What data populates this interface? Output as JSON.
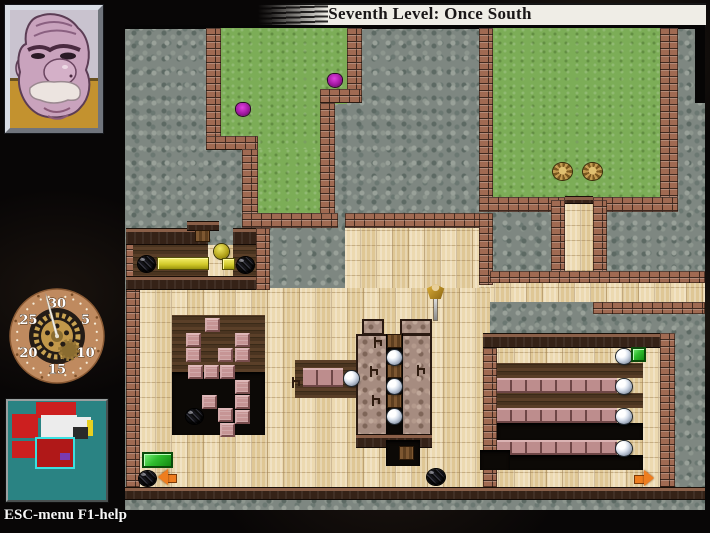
{
  "banner": {
    "title": "Seventh Level: Once South"
  },
  "hud": {
    "hint": "ESC-menu F1-help",
    "portrait": "beethro-face",
    "clock": {
      "labels": [
        {
          "text": "30",
          "angle": 0
        },
        {
          "text": "5",
          "angle": 60
        },
        {
          "text": "10",
          "angle": 120
        },
        {
          "text": "15",
          "angle": 180
        },
        {
          "text": "20",
          "angle": 240
        },
        {
          "text": "25",
          "angle": 300
        }
      ],
      "hand_angle": -15
    },
    "minimap": {
      "rooms": [
        {
          "t": "room",
          "x": 28,
          "y": 1,
          "w": 40,
          "h": 16,
          "c": "#cc1f1f"
        },
        {
          "t": "room",
          "x": 33,
          "y": 14,
          "w": 36,
          "h": 22,
          "c": "#ececec"
        },
        {
          "t": "room",
          "x": 67,
          "y": 16,
          "w": 16,
          "h": 17,
          "c": "#ececec"
        },
        {
          "t": "room",
          "x": 79,
          "y": 19,
          "w": 6,
          "h": 16,
          "c": "#e8d020"
        },
        {
          "t": "room",
          "x": 65,
          "y": 26,
          "w": 15,
          "h": 12,
          "c": "#2a2a2a"
        },
        {
          "t": "room",
          "x": 4,
          "y": 13,
          "w": 26,
          "h": 24,
          "c": "#cc1f1f"
        },
        {
          "t": "room",
          "x": 4,
          "y": 40,
          "w": 26,
          "h": 17,
          "c": "#cc1f1f"
        },
        {
          "t": "room",
          "x": 40,
          "y": 44,
          "w": 18,
          "h": 14,
          "c": "#cc1f1f"
        },
        {
          "t": "room-current",
          "x": 27,
          "y": 36,
          "w": 36,
          "h": 28,
          "c": "#b01818",
          "b": "#3ae0e0"
        },
        {
          "t": "room",
          "x": 52,
          "y": 52,
          "w": 10,
          "h": 7,
          "c": "#7a3ab0"
        }
      ]
    }
  },
  "map": {
    "regions": [
      {
        "t": "black",
        "x": 0,
        "y": 0,
        "w": 580,
        "h": 4
      },
      {
        "t": "black",
        "x": 570,
        "y": 0,
        "w": 10,
        "h": 78
      },
      {
        "t": "grass",
        "x": 96,
        "y": 3,
        "w": 126,
        "h": 76
      },
      {
        "t": "grass",
        "x": 96,
        "y": 3,
        "w": 99,
        "h": 122
      },
      {
        "t": "grass",
        "x": 133,
        "y": 124,
        "w": 62,
        "h": 66
      },
      {
        "t": "grass",
        "x": 368,
        "y": 3,
        "w": 167,
        "h": 171
      },
      {
        "t": "tan",
        "x": 440,
        "y": 175,
        "w": 28,
        "h": 85
      },
      {
        "t": "tan",
        "x": 220,
        "y": 203,
        "w": 145,
        "h": 62
      },
      {
        "t": "tan",
        "x": 354,
        "y": 258,
        "w": 226,
        "h": 19
      },
      {
        "t": "tan",
        "x": 15,
        "y": 263,
        "w": 350,
        "h": 199
      },
      {
        "t": "tan",
        "x": 358,
        "y": 323,
        "w": 177,
        "h": 139
      },
      {
        "t": "tan",
        "x": 83,
        "y": 220,
        "w": 25,
        "h": 33
      },
      {
        "t": "wall",
        "x": 81,
        "y": 3,
        "w": 15,
        "h": 122
      },
      {
        "t": "wall",
        "x": 81,
        "y": 111,
        "w": 52,
        "h": 14
      },
      {
        "t": "wall",
        "x": 117,
        "y": 124,
        "w": 16,
        "h": 66
      },
      {
        "t": "wall",
        "x": 222,
        "y": 3,
        "w": 15,
        "h": 75
      },
      {
        "t": "wall",
        "x": 195,
        "y": 64,
        "w": 42,
        "h": 14
      },
      {
        "t": "wall",
        "x": 195,
        "y": 78,
        "w": 15,
        "h": 112
      },
      {
        "t": "wall",
        "x": 117,
        "y": 188,
        "w": 96,
        "h": 15
      },
      {
        "t": "wall",
        "x": 354,
        "y": 3,
        "w": 14,
        "h": 184
      },
      {
        "t": "wall",
        "x": 535,
        "y": 3,
        "w": 18,
        "h": 184
      },
      {
        "t": "wall",
        "x": 354,
        "y": 172,
        "w": 86,
        "h": 15
      },
      {
        "t": "wall",
        "x": 468,
        "y": 172,
        "w": 85,
        "h": 15
      },
      {
        "t": "darkwall",
        "x": 440,
        "y": 171,
        "w": 28,
        "h": 8
      },
      {
        "t": "wall",
        "x": 426,
        "y": 175,
        "w": 14,
        "h": 73
      },
      {
        "t": "wall",
        "x": 468,
        "y": 175,
        "w": 14,
        "h": 73
      },
      {
        "t": "wall",
        "x": 220,
        "y": 188,
        "w": 148,
        "h": 15
      },
      {
        "t": "wall",
        "x": 354,
        "y": 188,
        "w": 14,
        "h": 72
      },
      {
        "t": "wall",
        "x": 365,
        "y": 246,
        "w": 215,
        "h": 12
      },
      {
        "t": "wall",
        "x": 468,
        "y": 277,
        "w": 112,
        "h": 12
      },
      {
        "t": "wall",
        "x": 1,
        "y": 218,
        "w": 14,
        "h": 244
      },
      {
        "t": "darkwall",
        "x": 1,
        "y": 203,
        "w": 82,
        "h": 17
      },
      {
        "t": "darkwall",
        "x": 108,
        "y": 203,
        "w": 27,
        "h": 17
      },
      {
        "t": "darkwall",
        "x": 62,
        "y": 196,
        "w": 32,
        "h": 10
      },
      {
        "t": "darkwood",
        "x": 8,
        "y": 220,
        "w": 75,
        "h": 33
      },
      {
        "t": "darkwood",
        "x": 108,
        "y": 220,
        "w": 25,
        "h": 33
      },
      {
        "t": "darkwall",
        "x": 1,
        "y": 251,
        "w": 132,
        "h": 14
      },
      {
        "t": "wall",
        "x": 131,
        "y": 203,
        "w": 14,
        "h": 62
      },
      {
        "t": "darkwood",
        "x": 47,
        "y": 290,
        "w": 93,
        "h": 57
      },
      {
        "t": "pit",
        "x": 47,
        "y": 347,
        "w": 93,
        "h": 63
      },
      {
        "t": "darkwall",
        "x": 358,
        "y": 308,
        "w": 177,
        "h": 15
      },
      {
        "t": "wall",
        "x": 358,
        "y": 323,
        "w": 14,
        "h": 139
      },
      {
        "t": "wall",
        "x": 535,
        "y": 308,
        "w": 15,
        "h": 154
      },
      {
        "t": "darkwood",
        "x": 372,
        "y": 338,
        "w": 146,
        "h": 15
      },
      {
        "t": "brickrow",
        "x": 372,
        "y": 353,
        "w": 120,
        "h": 15
      },
      {
        "t": "darkwood",
        "x": 372,
        "y": 368,
        "w": 146,
        "h": 15
      },
      {
        "t": "brickrow",
        "x": 372,
        "y": 383,
        "w": 120,
        "h": 15
      },
      {
        "t": "pit",
        "x": 372,
        "y": 398,
        "w": 146,
        "h": 17
      },
      {
        "t": "brickrow",
        "x": 372,
        "y": 415,
        "w": 120,
        "h": 15
      },
      {
        "t": "pit",
        "x": 372,
        "y": 430,
        "w": 146,
        "h": 15
      },
      {
        "t": "darkwood",
        "x": 170,
        "y": 335,
        "w": 72,
        "h": 38
      },
      {
        "t": "brickrow",
        "x": 178,
        "y": 343,
        "w": 40,
        "h": 19
      },
      {
        "t": "pinkcobble",
        "x": 237,
        "y": 294,
        "w": 22,
        "h": 16
      },
      {
        "t": "pinkcobble",
        "x": 275,
        "y": 294,
        "w": 32,
        "h": 16
      },
      {
        "t": "pinkcobble",
        "x": 231,
        "y": 309,
        "w": 76,
        "h": 102
      },
      {
        "t": "pit",
        "x": 261,
        "y": 309,
        "w": 17,
        "h": 100
      },
      {
        "t": "darkwall",
        "x": 231,
        "y": 409,
        "w": 76,
        "h": 14
      },
      {
        "t": "pit",
        "x": 261,
        "y": 415,
        "w": 34,
        "h": 26
      },
      {
        "t": "pit",
        "x": 355,
        "y": 425,
        "w": 30,
        "h": 20
      },
      {
        "t": "darkwall",
        "x": 0,
        "y": 462,
        "w": 580,
        "h": 13
      }
    ],
    "items": [
      {
        "t": "roach",
        "x": 111,
        "y": 78,
        "w": 14,
        "h": 13
      },
      {
        "t": "roach",
        "x": 203,
        "y": 49,
        "w": 14,
        "h": 13
      },
      {
        "t": "creature",
        "x": 428,
        "y": 138,
        "w": 19,
        "h": 17
      },
      {
        "t": "creature",
        "x": 458,
        "y": 138,
        "w": 19,
        "h": 17
      },
      {
        "t": "oliveorb",
        "x": 89,
        "y": 219,
        "w": 15,
        "h": 15
      },
      {
        "t": "bomb",
        "x": 13,
        "y": 231,
        "w": 17,
        "h": 16
      },
      {
        "t": "bomb",
        "x": 112,
        "y": 232,
        "w": 17,
        "h": 16
      },
      {
        "t": "bomb",
        "x": 61,
        "y": 384,
        "w": 17,
        "h": 15
      },
      {
        "t": "bomb",
        "x": 14,
        "y": 446,
        "w": 17,
        "h": 15
      },
      {
        "t": "bomb",
        "x": 302,
        "y": 444,
        "w": 18,
        "h": 16
      },
      {
        "t": "ydoor",
        "x": 32,
        "y": 232,
        "w": 52,
        "h": 13
      },
      {
        "t": "ydoor",
        "x": 97,
        "y": 233,
        "w": 13,
        "h": 12
      },
      {
        "t": "woodtile",
        "x": 70,
        "y": 205,
        "w": 15,
        "h": 12
      },
      {
        "t": "woodtile",
        "x": 262,
        "y": 309,
        "w": 15,
        "h": 14
      },
      {
        "t": "woodtile",
        "x": 262,
        "y": 339,
        "w": 15,
        "h": 14
      },
      {
        "t": "woodtile",
        "x": 262,
        "y": 369,
        "w": 15,
        "h": 14
      },
      {
        "t": "woodtile",
        "x": 274,
        "y": 421,
        "w": 15,
        "h": 14
      },
      {
        "t": "orb",
        "x": 219,
        "y": 346,
        "w": 15,
        "h": 15
      },
      {
        "t": "orb",
        "x": 262,
        "y": 325,
        "w": 15,
        "h": 15
      },
      {
        "t": "orb",
        "x": 262,
        "y": 354,
        "w": 15,
        "h": 15
      },
      {
        "t": "orb",
        "x": 262,
        "y": 384,
        "w": 15,
        "h": 15
      },
      {
        "t": "orb",
        "x": 491,
        "y": 324,
        "w": 16,
        "h": 15
      },
      {
        "t": "orb",
        "x": 491,
        "y": 354,
        "w": 16,
        "h": 15
      },
      {
        "t": "orb",
        "x": 491,
        "y": 384,
        "w": 16,
        "h": 15
      },
      {
        "t": "orb",
        "x": 491,
        "y": 416,
        "w": 16,
        "h": 15
      },
      {
        "t": "gdoor",
        "x": 17,
        "y": 427,
        "w": 31,
        "h": 16
      },
      {
        "t": "gdoor",
        "x": 506,
        "y": 322,
        "w": 15,
        "h": 15
      },
      {
        "t": "arrow-w",
        "x": 33,
        "y": 444,
        "w": 20,
        "h": 16
      },
      {
        "t": "arrow-e",
        "x": 508,
        "y": 445,
        "w": 21,
        "h": 17
      },
      {
        "t": "bracket",
        "x": 249,
        "y": 312,
        "w": 8,
        "h": 11
      },
      {
        "t": "bracket",
        "x": 245,
        "y": 341,
        "w": 8,
        "h": 11
      },
      {
        "t": "bracket",
        "x": 247,
        "y": 370,
        "w": 8,
        "h": 11
      },
      {
        "t": "bracket",
        "x": 292,
        "y": 340,
        "w": 8,
        "h": 11
      },
      {
        "t": "bracket",
        "x": 167,
        "y": 352,
        "w": 8,
        "h": 11
      },
      {
        "t": "pinkblock",
        "x": 80,
        "y": 293,
        "w": 15,
        "h": 14
      },
      {
        "t": "pinkblock",
        "x": 61,
        "y": 308,
        "w": 15,
        "h": 14
      },
      {
        "t": "pinkblock",
        "x": 110,
        "y": 308,
        "w": 15,
        "h": 14
      },
      {
        "t": "pinkblock",
        "x": 61,
        "y": 323,
        "w": 15,
        "h": 14
      },
      {
        "t": "pinkblock",
        "x": 93,
        "y": 323,
        "w": 15,
        "h": 14
      },
      {
        "t": "pinkblock",
        "x": 110,
        "y": 323,
        "w": 15,
        "h": 14
      },
      {
        "t": "pinkblock",
        "x": 63,
        "y": 340,
        "w": 15,
        "h": 14
      },
      {
        "t": "pinkblock",
        "x": 79,
        "y": 340,
        "w": 15,
        "h": 14
      },
      {
        "t": "pinkblock",
        "x": 95,
        "y": 340,
        "w": 15,
        "h": 14
      },
      {
        "t": "pinkblock",
        "x": 110,
        "y": 355,
        "w": 15,
        "h": 14
      },
      {
        "t": "pinkblock",
        "x": 77,
        "y": 370,
        "w": 15,
        "h": 14
      },
      {
        "t": "pinkblock",
        "x": 110,
        "y": 370,
        "w": 15,
        "h": 14
      },
      {
        "t": "pinkblock",
        "x": 93,
        "y": 383,
        "w": 15,
        "h": 14
      },
      {
        "t": "pinkblock",
        "x": 110,
        "y": 385,
        "w": 15,
        "h": 14
      },
      {
        "t": "pinkblock",
        "x": 95,
        "y": 398,
        "w": 15,
        "h": 14
      },
      {
        "t": "player",
        "x": 300,
        "y": 258,
        "w": 22,
        "h": 38
      }
    ]
  }
}
